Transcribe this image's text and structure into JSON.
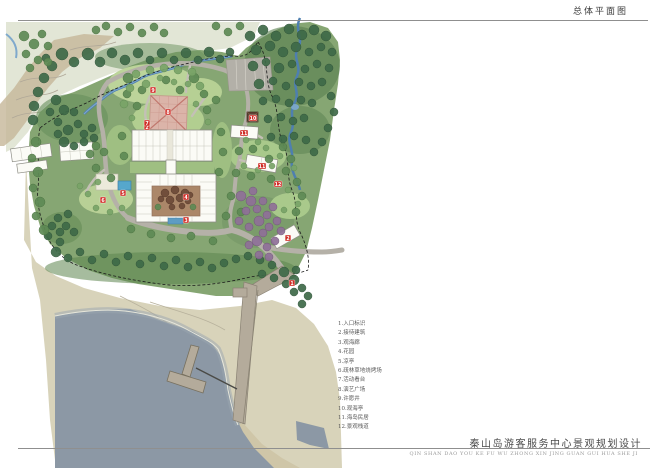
{
  "page": {
    "top_title": "总体平面图",
    "bottom_title": "秦山岛游客服务中心景观规划设计",
    "bottom_subtitle": "QIN SHAN DAO YOU KE FU WU ZHONG XIN JING GUAN GUI HUA SHE JI"
  },
  "legend": {
    "items": [
      {
        "num": "1",
        "label": "入口标识"
      },
      {
        "num": "2",
        "label": "接待建筑"
      },
      {
        "num": "3",
        "label": "观海廊"
      },
      {
        "num": "4",
        "label": "花园"
      },
      {
        "num": "5",
        "label": "凉亭"
      },
      {
        "num": "6",
        "label": "疏林草地烧烤场"
      },
      {
        "num": "7",
        "label": "活动看台"
      },
      {
        "num": "8",
        "label": "演艺广场"
      },
      {
        "num": "9",
        "label": "许愿井"
      },
      {
        "num": "10",
        "label": "观海亭"
      },
      {
        "num": "11",
        "label": "海岛民居"
      },
      {
        "num": "12",
        "label": "景观栈道"
      }
    ]
  },
  "map": {
    "marker_color": "#cf2b24",
    "markers": [
      {
        "num": "1",
        "x": 292,
        "y": 283
      },
      {
        "num": "2",
        "x": 288,
        "y": 238
      },
      {
        "num": "2",
        "x": 147,
        "y": 127
      },
      {
        "num": "3",
        "x": 186,
        "y": 220
      },
      {
        "num": "4",
        "x": 186,
        "y": 197
      },
      {
        "num": "5",
        "x": 123,
        "y": 193
      },
      {
        "num": "6",
        "x": 103,
        "y": 200
      },
      {
        "num": "7",
        "x": 147,
        "y": 123
      },
      {
        "num": "8",
        "x": 168,
        "y": 112
      },
      {
        "num": "9",
        "x": 153,
        "y": 90
      },
      {
        "num": "10",
        "x": 253,
        "y": 118
      },
      {
        "num": "11",
        "x": 244,
        "y": 133
      },
      {
        "num": "11",
        "x": 262,
        "y": 166
      },
      {
        "num": "12",
        "x": 278,
        "y": 184
      }
    ]
  },
  "colors": {
    "sea": "#8c98a5",
    "sand": "#d8d3ba",
    "land_green": "#86a673",
    "forest_dark": "#3e6a48",
    "lawn": "#b8d096",
    "road": "#b5b1a8",
    "pier": "#b4ab9b",
    "stream_blue": "#4e7fb0",
    "plaza_pink": "#dbb4a9",
    "courtyard_brown": "#aa8666",
    "building_white": "#fbfbf6",
    "marker_red": "#cf2b24"
  }
}
